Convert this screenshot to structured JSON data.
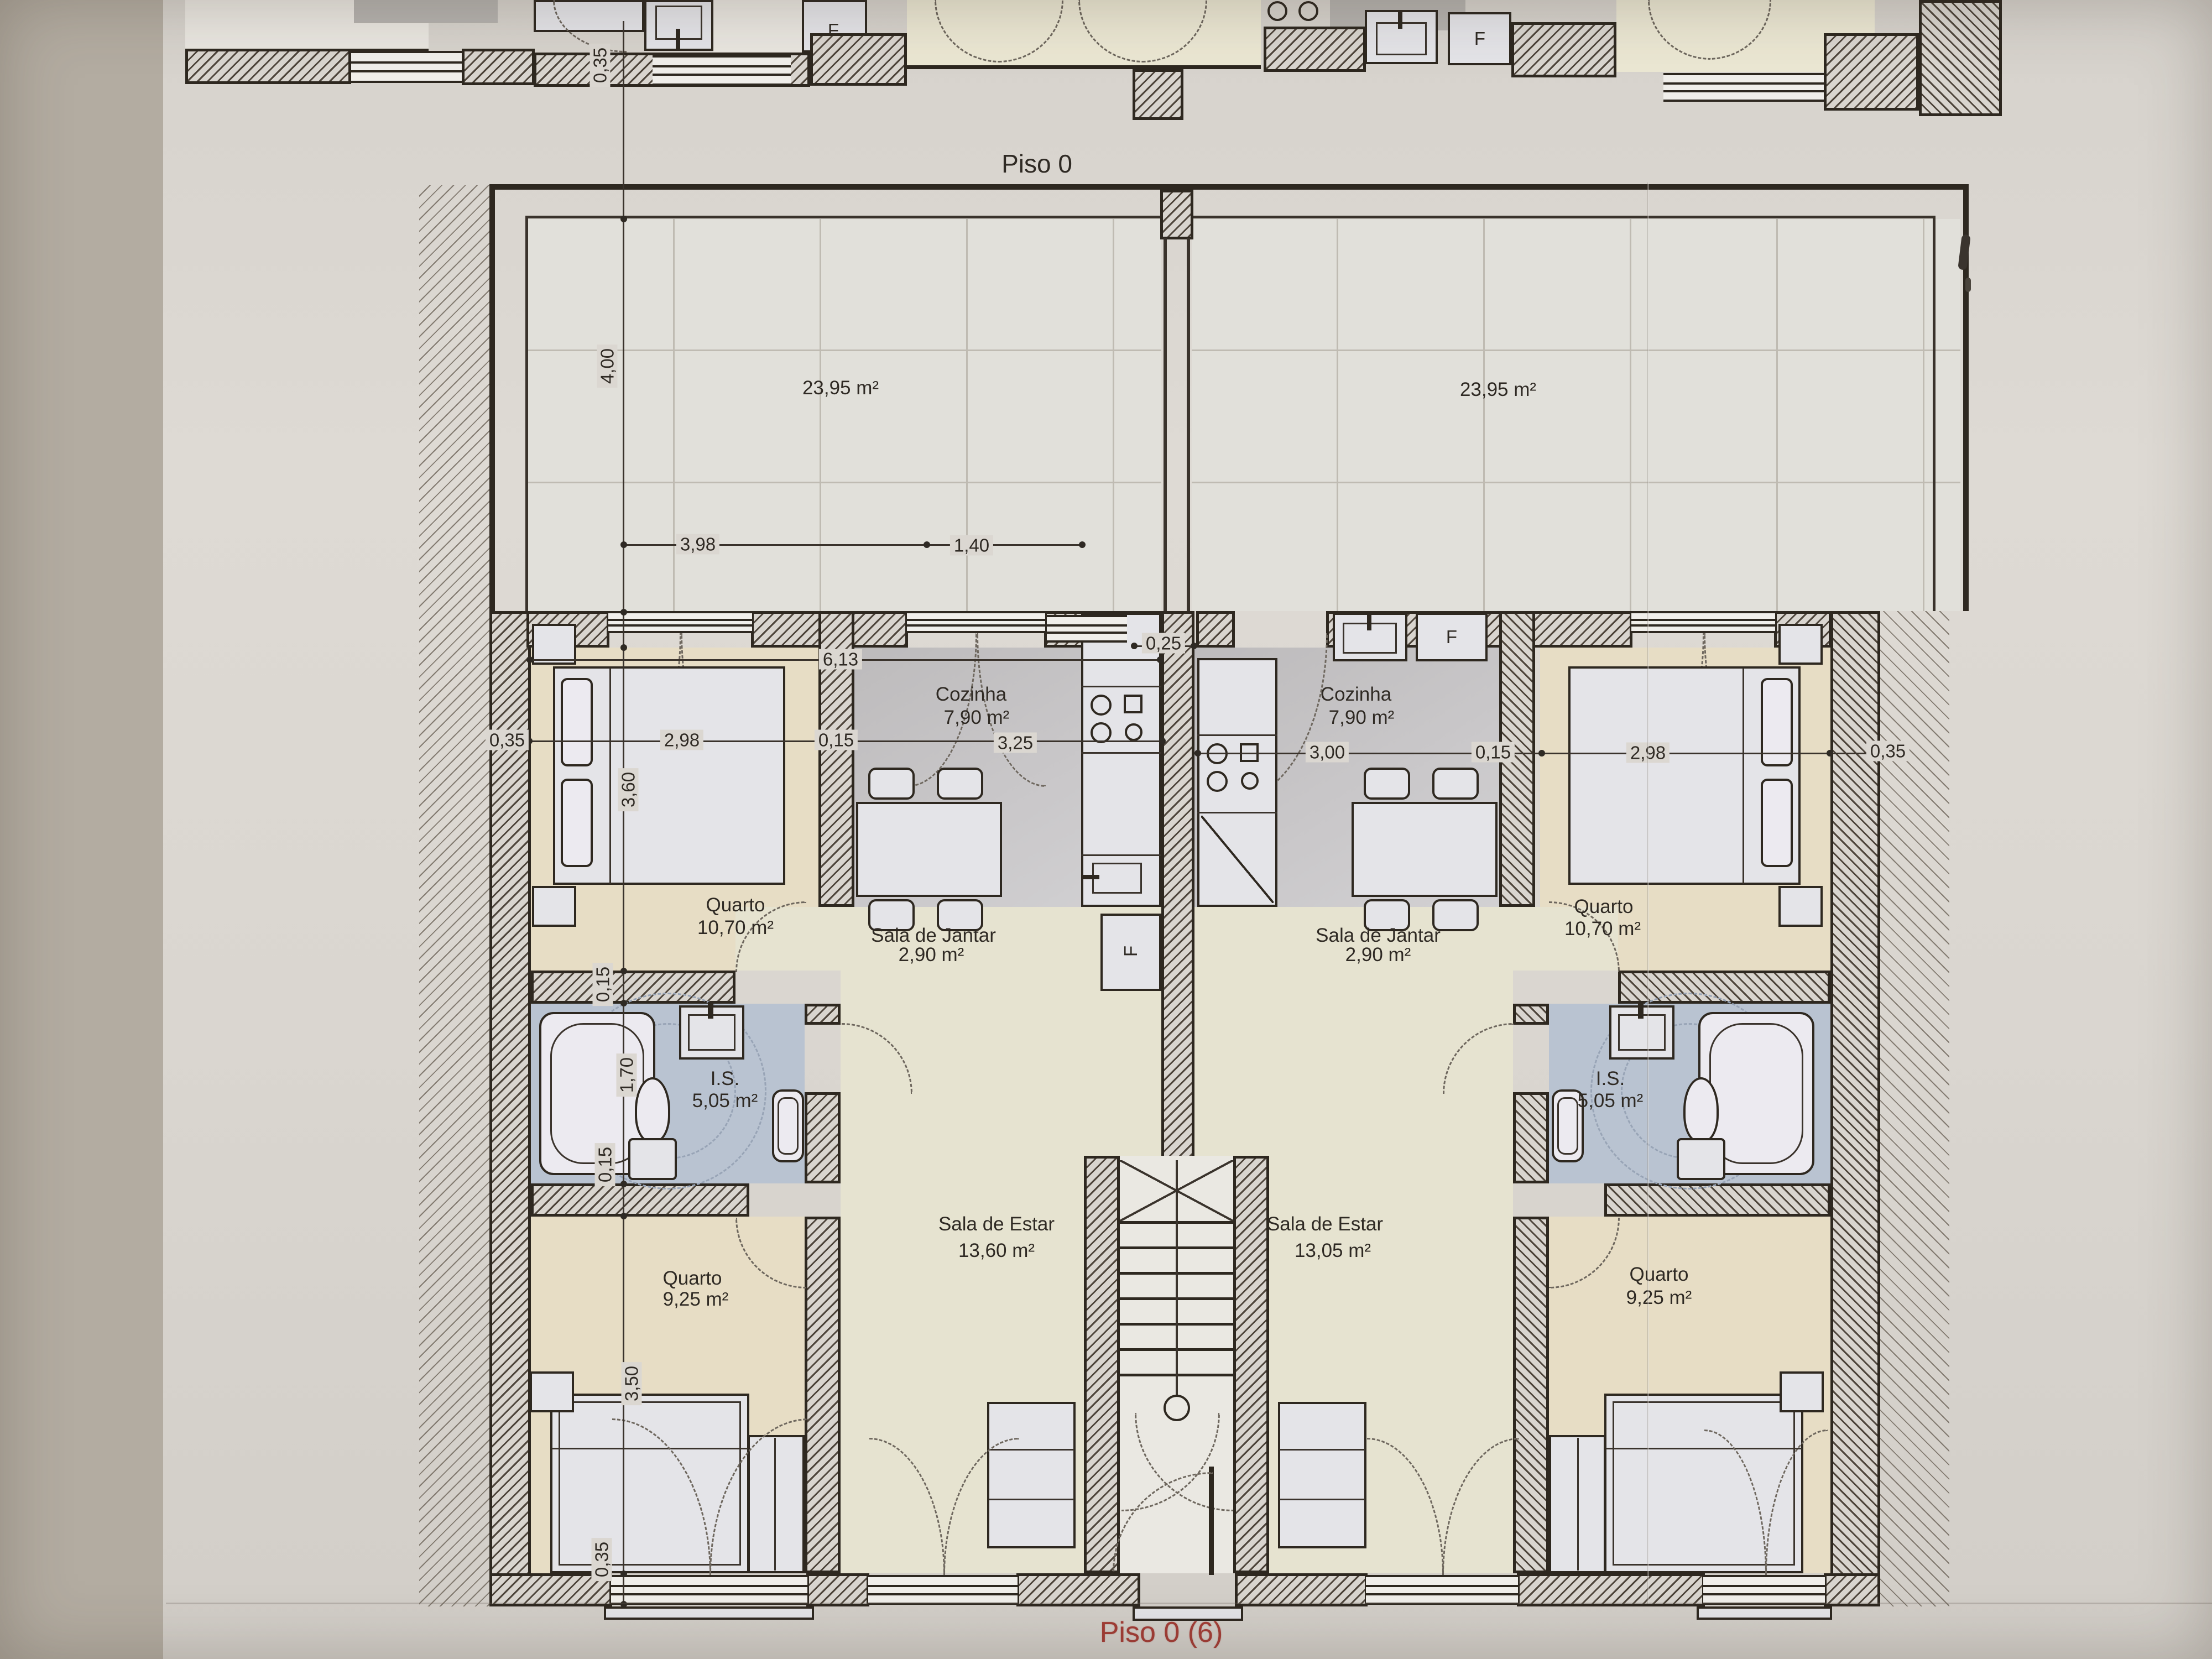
{
  "page": {
    "title": "Piso 0",
    "sheet_label": "Piso 0 (6)"
  },
  "terraces": {
    "left": {
      "area": "23,95 m²"
    },
    "right": {
      "area": "23,95 m²"
    }
  },
  "units": {
    "left": {
      "cozinha": {
        "name": "Cozinha",
        "area": "7,90 m²"
      },
      "sala_jantar": {
        "name": "Sala de Jantar",
        "area": "2,90 m²"
      },
      "quarto_1": {
        "name": "Quarto",
        "area": "10,70 m²"
      },
      "is": {
        "name": "I.S.",
        "area": "5,05 m²"
      },
      "quarto_2": {
        "name": "Quarto",
        "area": "9,25 m²"
      },
      "sala_estar": {
        "name": "Sala de Estar",
        "area": "13,60 m²"
      }
    },
    "right": {
      "cozinha": {
        "name": "Cozinha",
        "area": "7,90 m²"
      },
      "sala_jantar": {
        "name": "Sala de Jantar",
        "area": "2,90 m²"
      },
      "quarto_1": {
        "name": "Quarto",
        "area": "10,70 m²"
      },
      "is": {
        "name": "I.S.",
        "area": "5,05 m²"
      },
      "quarto_2": {
        "name": "Quarto",
        "area": "9,25 m²"
      },
      "sala_estar": {
        "name": "Sala de Estar",
        "area": "13,05 m²"
      }
    }
  },
  "dimensions": {
    "top_wall": "0,35",
    "terrace_depth": "4,00",
    "terrace_w1": "3,98",
    "terrace_w2": "1,40",
    "unit_width": "6,13",
    "center_wall": "0,25",
    "left_out_wall": "0,35",
    "left_room_w": "2,98",
    "left_mid_wall": "0,15",
    "left_kitchen_w": "3,25",
    "left_room_h": "3,60",
    "right_kitchen_w": "3,00",
    "right_mid_wall": "0,15",
    "right_room_w": "2,98",
    "right_out_wall": "0,35",
    "wall_a": "0,15",
    "bath_h": "1,70",
    "wall_b": "0,15",
    "room2_h": "3,50",
    "bottom_wall": "0,35"
  },
  "fixtures": {
    "fridge_label": "F"
  },
  "colors": {
    "paper": "#dbd7d1",
    "line": "#2e2820",
    "bath_floor": "#b9c3d1",
    "bedroom_floor": "#e7ddc5",
    "kitchen_floor": "#c9c7c9",
    "living_floor": "#e6e3d0",
    "sheet_label_red": "#a23d36"
  }
}
